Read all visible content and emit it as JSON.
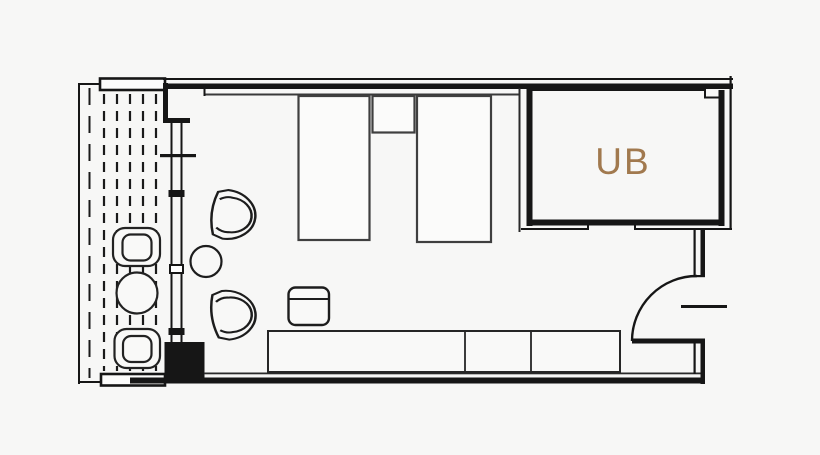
{
  "plan": {
    "room_label": "UB",
    "colors": {
      "background": "#f7f7f6",
      "wall_line": "#161616",
      "furniture_line": "#2e2e2e",
      "bed_line": "#3f3f3f",
      "light_fill": "#fbfbfa",
      "ub_label": "#a1794e"
    }
  }
}
